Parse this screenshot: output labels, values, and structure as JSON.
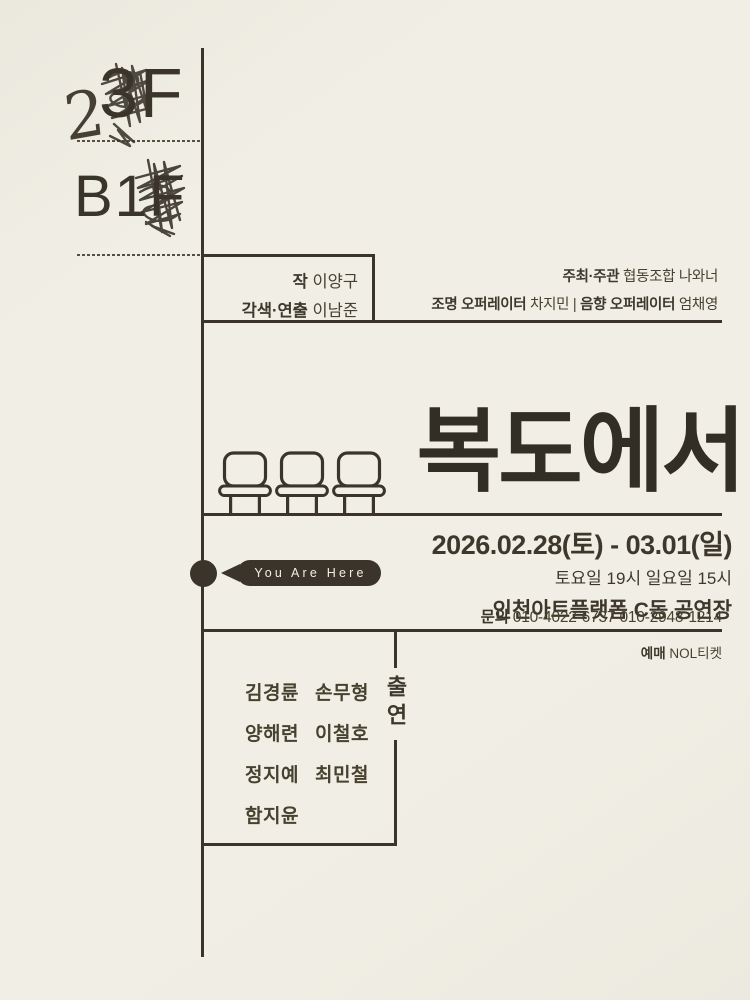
{
  "colors": {
    "paper": "#f1efe5",
    "ink": "#3a342b",
    "pill_text": "#f3f0e3"
  },
  "floors": {
    "top_corrected": "2",
    "top_original": "3F",
    "bottom": "B1F"
  },
  "credits_box": {
    "lines": [
      {
        "label": "작",
        "value": "이양구"
      },
      {
        "label": "각색·연출",
        "value": "이남준"
      }
    ]
  },
  "organizers": {
    "host_label": "주최·주관",
    "host_value": "협동조합 나와너",
    "light_label": "조명 오퍼레이터",
    "light_value": "차지민",
    "divider": "|",
    "sound_label": "음향 오퍼레이터",
    "sound_value": "엄채영"
  },
  "title": "복도에서",
  "schedule": {
    "dates": "2026.02.28(토) - 03.01(일)",
    "times": "토요일 19시 일요일 15시",
    "venue": "인천아트플랫폼 C동 공연장"
  },
  "marker": {
    "label": "You Are Here"
  },
  "contact": {
    "label": "문의",
    "numbers": "010-4022-6737 010-2948-1214"
  },
  "ticketing": {
    "label": "예매",
    "value": "NOL티켓"
  },
  "cast": {
    "heading": "출연",
    "column1": [
      "김경륜",
      "양해련",
      "정지예",
      "함지윤"
    ],
    "column2": [
      "손무형",
      "이철호",
      "최민철"
    ]
  },
  "icons": {
    "chair": "chair-icon",
    "scribble": "scribble-icon",
    "you_are_here_dot": "map-dot-icon",
    "you_are_here_arrow": "arrow-left-icon"
  }
}
